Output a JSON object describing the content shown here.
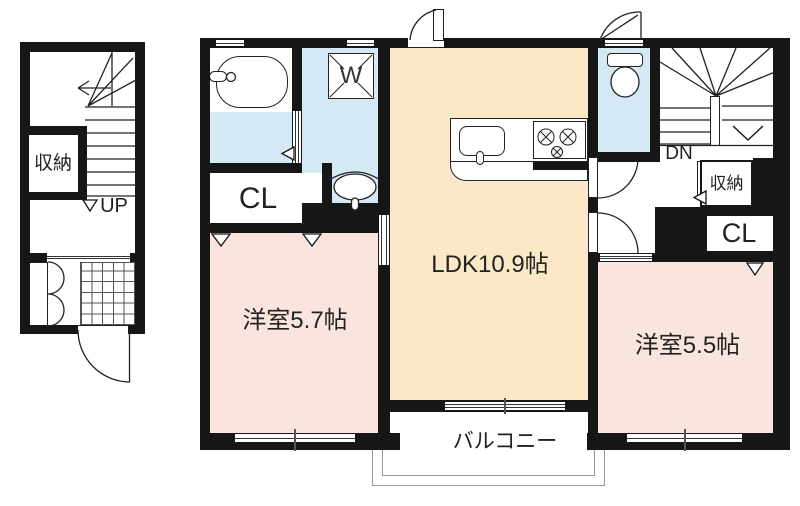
{
  "floor1": {
    "storage_label": "収納",
    "up_label": "UP"
  },
  "floor2": {
    "ldk_label": "LDK10.9帖",
    "bedroom_left_label": "洋室5.7帖",
    "bedroom_right_label": "洋室5.5帖",
    "balcony_label": "バルコニー",
    "closet_left_label": "CL",
    "closet_right_label": "CL",
    "storage_label": "収納",
    "down_label": "DN",
    "washer_label": "W"
  },
  "colors": {
    "wall": "#161616",
    "ldk_floor": "#FAE8C6",
    "bedroom_floor": "#F9E4DE",
    "wet_floor": "#D5E9F5",
    "railing": "#999999"
  }
}
